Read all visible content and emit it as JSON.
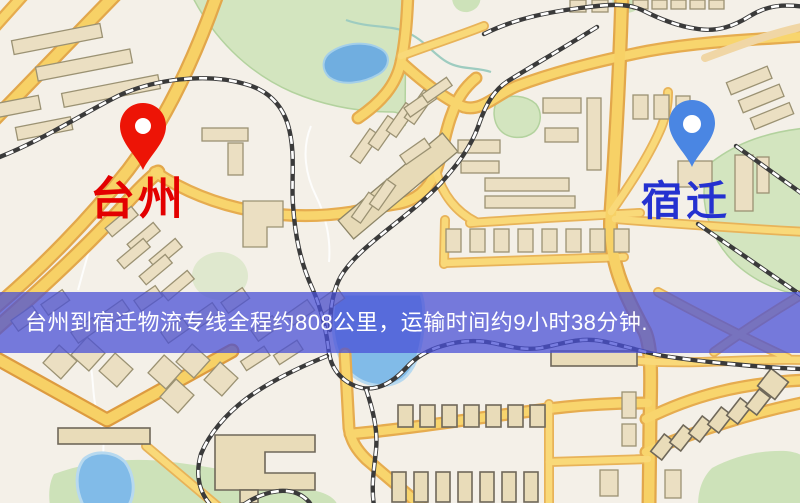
{
  "map": {
    "markers": [
      {
        "id": "origin",
        "label": "台州",
        "pin_color": "#e81508",
        "label_color": "#e30000"
      },
      {
        "id": "destination",
        "label": "宿迁",
        "pin_color": "#4c86e0",
        "label_color": "#2431d0"
      }
    ]
  },
  "banner": {
    "text": "台州到宿迁物流专线全程约808公里，运输时间约9小时38分钟.",
    "distance_text": "约808公里",
    "duration_text": "约9小时38分钟",
    "background_color": "#4a4fd6",
    "text_color": "#ffffff"
  }
}
